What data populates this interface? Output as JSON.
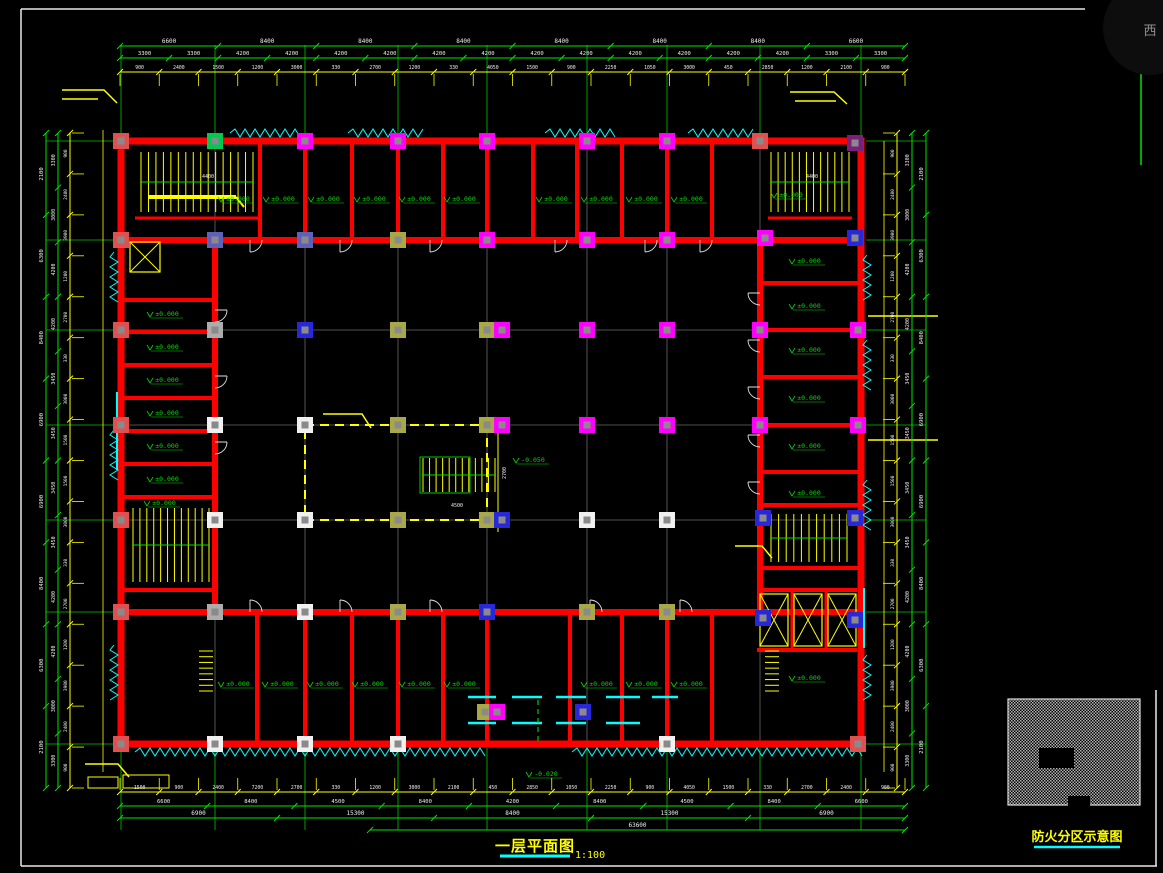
{
  "canvas": {
    "width": 1163,
    "height": 873,
    "background": "#000000"
  },
  "watermark": {
    "text": "西"
  },
  "titles": {
    "main": {
      "text": "一层平面图",
      "scale": "1:100"
    },
    "key": {
      "text": "防火分区示意图"
    }
  },
  "palette": {
    "wall_red": "#FF0000",
    "dim_green": "#00E400",
    "dim_yellow": "#FFFF00",
    "window_cyan": "#00FFFF",
    "grid_gray": "#6A6A6A",
    "dim_text_white": "#EDEDED",
    "label_green": "#00DD00",
    "title_yellow": "#FFFF00",
    "underline_cyan": "#00FFFF",
    "column_colors": {
      "red": "#E05050",
      "magenta": "#FF00FF",
      "blue": "#2828D8",
      "slate": "#6060B8",
      "olive": "#A8A848",
      "green": "#00C850",
      "white": "#F0F0F0",
      "gray": "#ACACAC",
      "purple": "#7A2078"
    }
  },
  "plan": {
    "grid": {
      "xs": [
        121,
        215,
        305,
        398,
        487,
        587,
        667,
        760,
        861
      ],
      "ys": [
        141,
        240,
        330,
        425,
        520,
        612,
        744
      ]
    },
    "elevation_text": "±0.000",
    "center_elevation": "-0.050",
    "center_elevation_pos": [
      532,
      462
    ],
    "entrance_elevation": "-0.020",
    "entrance_elevation_pos": [
      545,
      776
    ],
    "elevation_labels": [
      [
        237,
        201
      ],
      [
        282,
        201
      ],
      [
        327,
        201
      ],
      [
        373,
        201
      ],
      [
        418,
        201
      ],
      [
        463,
        201
      ],
      [
        555,
        201
      ],
      [
        600,
        201
      ],
      [
        645,
        201
      ],
      [
        690,
        201
      ],
      [
        790,
        197
      ],
      [
        166,
        316
      ],
      [
        166,
        349
      ],
      [
        166,
        382
      ],
      [
        166,
        415
      ],
      [
        166,
        448
      ],
      [
        166,
        481
      ],
      [
        163,
        505
      ],
      [
        808,
        263
      ],
      [
        808,
        308
      ],
      [
        808,
        352
      ],
      [
        808,
        400
      ],
      [
        808,
        448
      ],
      [
        808,
        495
      ],
      [
        808,
        680
      ],
      [
        237,
        686
      ],
      [
        281,
        686
      ],
      [
        326,
        686
      ],
      [
        371,
        686
      ],
      [
        418,
        686
      ],
      [
        463,
        686
      ],
      [
        600,
        686
      ],
      [
        645,
        686
      ],
      [
        690,
        686
      ]
    ],
    "columns": [
      [
        121,
        141,
        "red"
      ],
      [
        215,
        141,
        "green"
      ],
      [
        305,
        141,
        "magenta"
      ],
      [
        398,
        141,
        "magenta"
      ],
      [
        487,
        141,
        "magenta"
      ],
      [
        587,
        141,
        "magenta"
      ],
      [
        667,
        141,
        "magenta"
      ],
      [
        760,
        141,
        "red"
      ],
      [
        855,
        143,
        "purple"
      ],
      [
        121,
        240,
        "red"
      ],
      [
        215,
        240,
        "slate"
      ],
      [
        305,
        240,
        "slate"
      ],
      [
        398,
        240,
        "olive"
      ],
      [
        487,
        240,
        "magenta"
      ],
      [
        587,
        240,
        "magenta"
      ],
      [
        667,
        240,
        "magenta"
      ],
      [
        765,
        238,
        "magenta"
      ],
      [
        855,
        238,
        "blue"
      ],
      [
        121,
        330,
        "red"
      ],
      [
        215,
        330,
        "gray"
      ],
      [
        305,
        330,
        "blue"
      ],
      [
        398,
        330,
        "olive"
      ],
      [
        487,
        330,
        "olive"
      ],
      [
        502,
        330,
        "magenta"
      ],
      [
        587,
        330,
        "magenta"
      ],
      [
        667,
        330,
        "magenta"
      ],
      [
        760,
        330,
        "magenta"
      ],
      [
        858,
        330,
        "magenta"
      ],
      [
        121,
        425,
        "red"
      ],
      [
        215,
        425,
        "white"
      ],
      [
        305,
        425,
        "white"
      ],
      [
        398,
        425,
        "olive"
      ],
      [
        487,
        425,
        "olive"
      ],
      [
        502,
        425,
        "magenta"
      ],
      [
        587,
        425,
        "magenta"
      ],
      [
        667,
        425,
        "magenta"
      ],
      [
        760,
        425,
        "magenta"
      ],
      [
        858,
        425,
        "magenta"
      ],
      [
        121,
        520,
        "red"
      ],
      [
        215,
        520,
        "white"
      ],
      [
        305,
        520,
        "white"
      ],
      [
        398,
        520,
        "olive"
      ],
      [
        487,
        520,
        "olive"
      ],
      [
        502,
        520,
        "blue"
      ],
      [
        587,
        520,
        "white"
      ],
      [
        667,
        520,
        "white"
      ],
      [
        763,
        518,
        "blue"
      ],
      [
        855,
        518,
        "blue"
      ],
      [
        121,
        612,
        "red"
      ],
      [
        215,
        612,
        "gray"
      ],
      [
        305,
        612,
        "white"
      ],
      [
        398,
        612,
        "olive"
      ],
      [
        487,
        612,
        "blue"
      ],
      [
        587,
        612,
        "olive"
      ],
      [
        667,
        612,
        "olive"
      ],
      [
        763,
        618,
        "blue"
      ],
      [
        855,
        620,
        "blue"
      ],
      [
        121,
        744,
        "red"
      ],
      [
        215,
        744,
        "white"
      ],
      [
        305,
        744,
        "white"
      ],
      [
        398,
        744,
        "white"
      ],
      [
        667,
        744,
        "white"
      ],
      [
        858,
        744,
        "red"
      ],
      [
        485,
        712,
        "olive"
      ],
      [
        497,
        712,
        "magenta"
      ],
      [
        583,
        712,
        "blue"
      ]
    ]
  },
  "inner_dims": [
    {
      "t": "4500",
      "x": 457,
      "y": 507,
      "r": 0
    },
    {
      "t": "2700",
      "x": 506,
      "y": 473,
      "r": 1
    },
    {
      "t": "4400",
      "x": 208,
      "y": 178,
      "r": 0
    },
    {
      "t": "4400",
      "x": 812,
      "y": 178,
      "r": 0
    }
  ],
  "dim_rows": [
    {
      "id": "top1",
      "axis": "x",
      "text_pos": 43,
      "line_pos": 46,
      "c": "g",
      "size": 6,
      "from": 120,
      "to": 905,
      "values": [
        "6600",
        "8400",
        "8400",
        "8400",
        "8400",
        "8400",
        "8400",
        "6600"
      ]
    },
    {
      "id": "top2",
      "axis": "x",
      "text_pos": 55,
      "line_pos": 58,
      "c": "g",
      "size": 5.5,
      "from": 120,
      "to": 905,
      "values": [
        "3300",
        "3300",
        "4200",
        "4200",
        "4200",
        "4200",
        "4200",
        "4200",
        "4200",
        "4200",
        "4200",
        "4200",
        "4200",
        "4200",
        "3300",
        "3300"
      ]
    },
    {
      "id": "top3",
      "axis": "x",
      "text_pos": 69,
      "line_pos": 72,
      "c": "y",
      "size": 4.8,
      "ext": true,
      "from": 120,
      "to": 905,
      "values": [
        "900",
        "2400",
        "1500",
        "1200",
        "3000",
        "330",
        "2700",
        "1200",
        "330",
        "4050",
        "1500",
        "900",
        "2250",
        "1050",
        "3000",
        "450",
        "2850",
        "1200",
        "2100",
        "900"
      ]
    },
    {
      "id": "bottom1",
      "axis": "x",
      "text_pos": 789,
      "line_pos": 792,
      "c": "y",
      "size": 4.8,
      "ext": true,
      "from": 120,
      "to": 905,
      "values": [
        "1500",
        "900",
        "2400",
        "7200",
        "2700",
        "330",
        "1200",
        "3000",
        "2100",
        "450",
        "2850",
        "1050",
        "2250",
        "900",
        "4050",
        "1500",
        "330",
        "2700",
        "2400",
        "900"
      ]
    },
    {
      "id": "bottom2",
      "axis": "x",
      "text_pos": 803,
      "line_pos": 806,
      "c": "g",
      "size": 5.5,
      "from": 120,
      "to": 905,
      "values": [
        "6600",
        "8400",
        "4500",
        "8400",
        "4200",
        "8400",
        "4500",
        "8400",
        "6600"
      ]
    },
    {
      "id": "bottom3",
      "axis": "x",
      "text_pos": 815,
      "line_pos": 818,
      "c": "g",
      "size": 6,
      "from": 120,
      "to": 905,
      "values": [
        "6900",
        "15300",
        "8400",
        "15300",
        "6900"
      ]
    },
    {
      "id": "bottom4",
      "axis": "x",
      "text_pos": 827,
      "line_pos": 830,
      "c": "g",
      "size": 6,
      "from": 370,
      "to": 905,
      "values": [
        "63600"
      ]
    },
    {
      "id": "left1",
      "axis": "y",
      "text_pos": 43,
      "line_pos": 46,
      "c": "g",
      "size": 5.5,
      "from": 133,
      "to": 788,
      "values": [
        "2100",
        "6300",
        "8400",
        "6900",
        "6900",
        "8400",
        "6300",
        "2100"
      ]
    },
    {
      "id": "left2",
      "axis": "y",
      "text_pos": 55,
      "line_pos": 58,
      "c": "g",
      "size": 5,
      "from": 133,
      "to": 788,
      "values": [
        "3300",
        "3000",
        "4200",
        "4200",
        "3450",
        "3450",
        "3450",
        "3450",
        "4200",
        "4200",
        "3000",
        "3300"
      ]
    },
    {
      "id": "left3",
      "axis": "y",
      "text_pos": 67,
      "line_pos": 70,
      "c": "y",
      "size": 4.5,
      "ext": true,
      "from": 133,
      "to": 788,
      "values": [
        "900",
        "2400",
        "3900",
        "1200",
        "2700",
        "330",
        "3000",
        "1500",
        "1500",
        "3000",
        "330",
        "2700",
        "1200",
        "3900",
        "2400",
        "900"
      ]
    },
    {
      "id": "right3",
      "axis": "y",
      "text_pos": 894,
      "line_pos": 897,
      "c": "y",
      "size": 4.5,
      "ext": true,
      "from": 133,
      "to": 788,
      "values": [
        "900",
        "2400",
        "3900",
        "1200",
        "2700",
        "330",
        "3000",
        "1500",
        "1500",
        "3000",
        "330",
        "2700",
        "1200",
        "3900",
        "2400",
        "900"
      ]
    },
    {
      "id": "right2",
      "axis": "y",
      "text_pos": 909,
      "line_pos": 912,
      "c": "g",
      "size": 5,
      "from": 133,
      "to": 788,
      "values": [
        "3300",
        "3000",
        "4200",
        "4200",
        "3450",
        "3450",
        "3450",
        "3450",
        "4200",
        "4200",
        "3000",
        "3300"
      ]
    },
    {
      "id": "right1",
      "axis": "y",
      "text_pos": 923,
      "line_pos": 926,
      "c": "g",
      "size": 5.5,
      "from": 133,
      "to": 788,
      "values": [
        "2100",
        "6300",
        "8400",
        "6900",
        "6900",
        "8400",
        "6300",
        "2100"
      ]
    }
  ]
}
